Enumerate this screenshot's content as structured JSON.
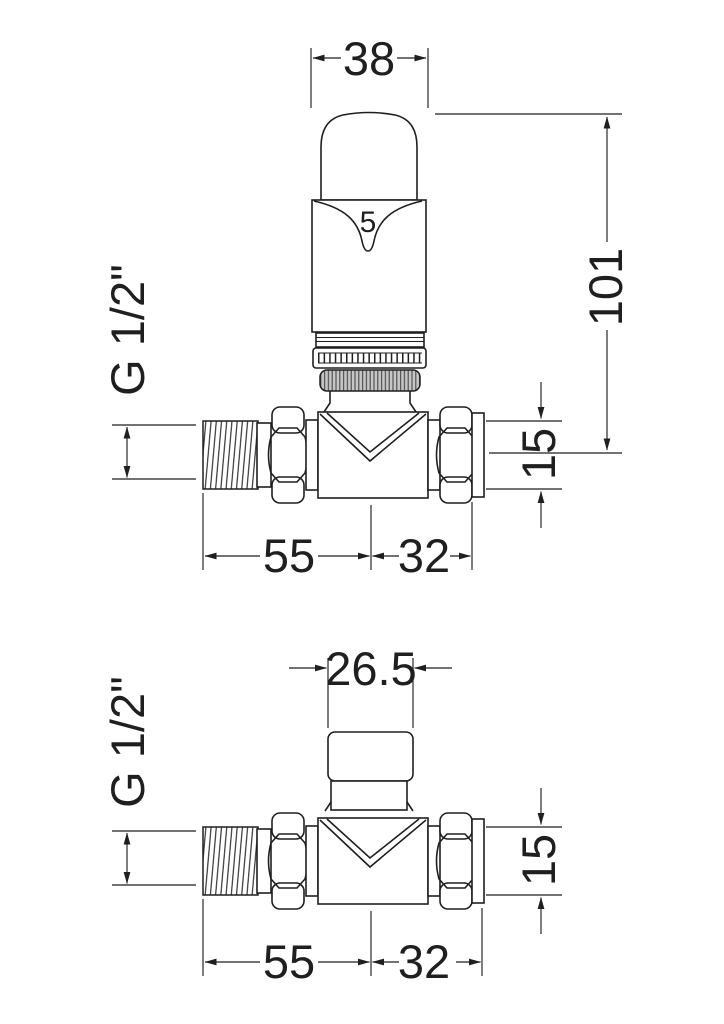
{
  "meta": {
    "background": "#ffffff",
    "line_color": "#1f1f1f",
    "knurl_fill": "#c6c6c6"
  },
  "top_view": {
    "head_setting": "5",
    "dim_head_width": "38",
    "dim_height": "101",
    "thread_label": "G 1/2\"",
    "dim_pipe": "15",
    "dim_left_length": "55",
    "dim_right_length": "32"
  },
  "bottom_view": {
    "dim_cap_width": "26.5",
    "thread_label": "G 1/2\"",
    "dim_pipe": "15",
    "dim_left_length": "55",
    "dim_right_length": "32"
  }
}
